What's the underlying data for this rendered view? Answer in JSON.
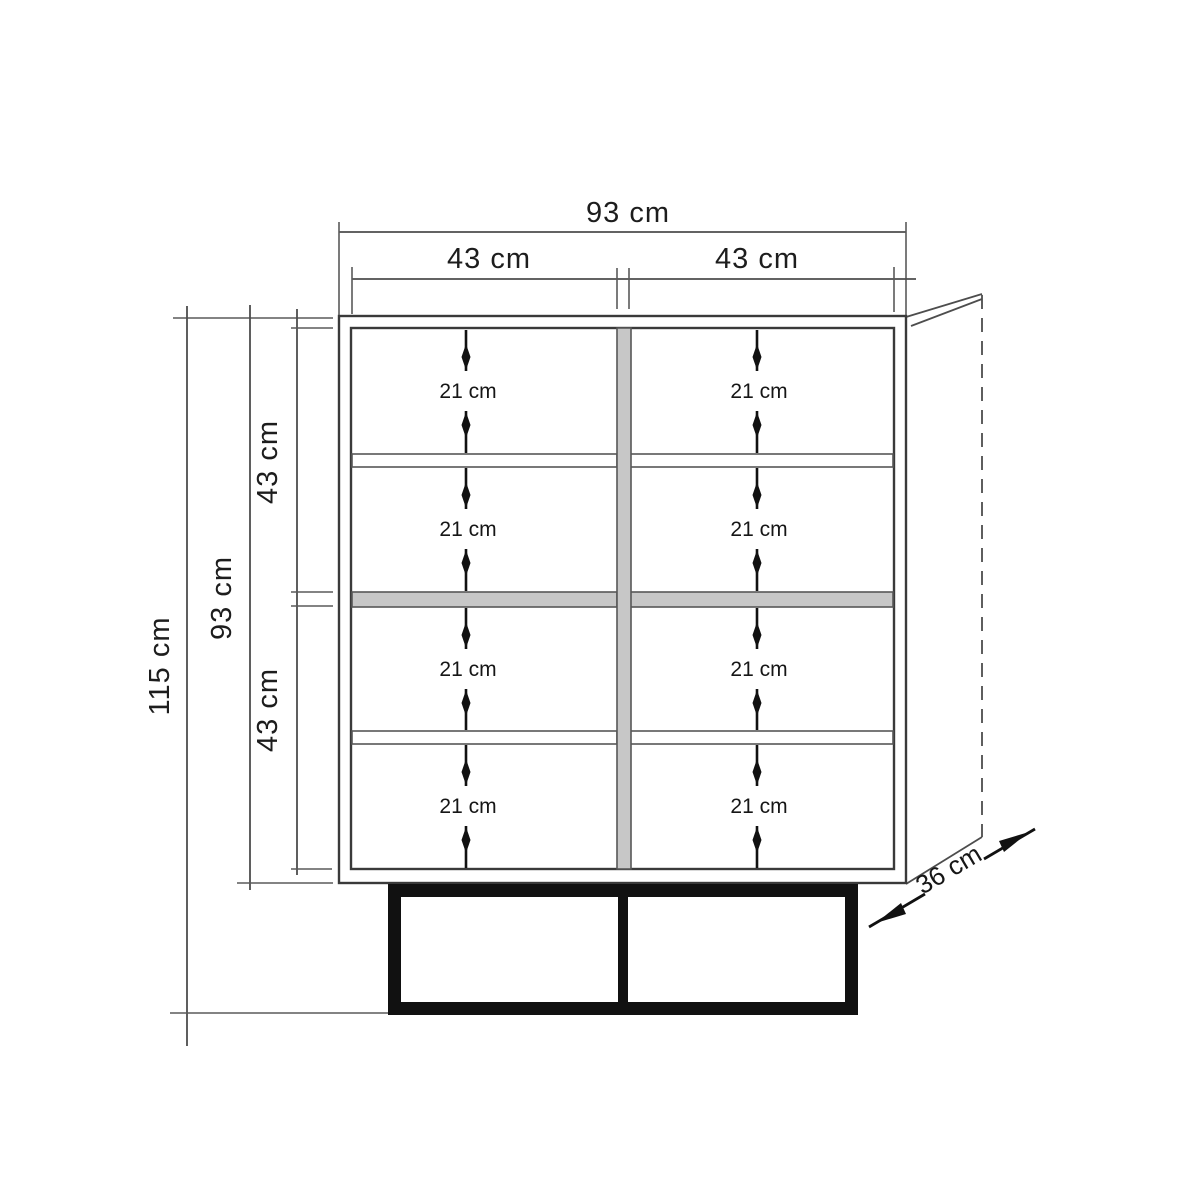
{
  "diagram": {
    "top_dimensions": {
      "overall_width": "93 cm",
      "left_door_width": "43 cm",
      "right_door_width": "43 cm"
    },
    "side_dimensions": {
      "overall_height": "115 cm",
      "body_height": "93 cm",
      "upper_section": "43 cm",
      "lower_section": "43 cm"
    },
    "depth_dimension": "36 cm",
    "compartments": [
      {
        "label": "21 cm"
      },
      {
        "label": "21 cm"
      },
      {
        "label": "21 cm"
      },
      {
        "label": "21 cm"
      },
      {
        "label": "21 cm"
      },
      {
        "label": "21 cm"
      },
      {
        "label": "21 cm"
      },
      {
        "label": "21 cm"
      }
    ],
    "colors": {
      "line": "#3a3a3a",
      "shelf_fill": "#c7c7c7",
      "base_fill": "#111111",
      "background": "#ffffff"
    }
  }
}
